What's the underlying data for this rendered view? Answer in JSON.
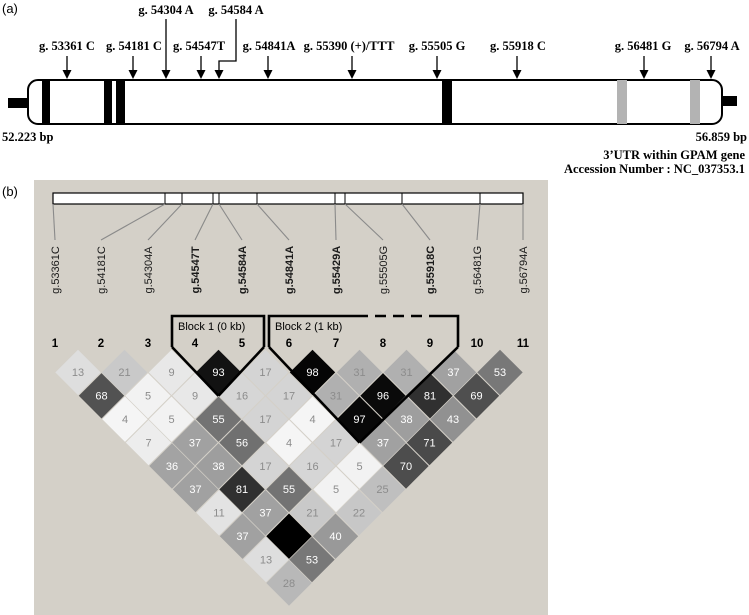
{
  "figure": {
    "panel_a": {
      "tag": "(a)",
      "start_bp": "52.223 bp",
      "end_bp": "56.859 bp",
      "caption_line1": "3’UTR within GPAM gene",
      "caption_line2": "Accession Number : NC_037353.1",
      "markers": [
        {
          "label": "g. 53361 C",
          "row": "mid",
          "label_x": 67,
          "arrow_x": 67,
          "connector": "straight"
        },
        {
          "label": "g. 54181 C",
          "row": "mid",
          "label_x": 134,
          "arrow_x": 133,
          "connector": "straight"
        },
        {
          "label": "g. 54304 A",
          "row": "top",
          "label_x": 166,
          "arrow_x": 166,
          "connector": "long"
        },
        {
          "label": "g. 54547T",
          "row": "mid",
          "label_x": 199,
          "arrow_x": 201,
          "connector": "straight"
        },
        {
          "label": "g. 54584 A",
          "row": "top",
          "label_x": 236,
          "arrow_x": 219,
          "connector": "elbow"
        },
        {
          "label": "g. 54841A",
          "row": "mid",
          "label_x": 269,
          "arrow_x": 268,
          "connector": "straight"
        },
        {
          "label": "g. 55390 (+)/TTT",
          "row": "mid",
          "label_x": 349,
          "arrow_x": 352,
          "connector": "straight"
        },
        {
          "label": "g. 55505 G",
          "row": "mid",
          "label_x": 437,
          "arrow_x": 437,
          "connector": "straight"
        },
        {
          "label": "g. 55918 C",
          "row": "mid",
          "label_x": 518,
          "arrow_x": 517,
          "connector": "straight"
        },
        {
          "label": "g. 56481 G",
          "row": "mid",
          "label_x": 643,
          "arrow_x": 644,
          "connector": "straight"
        },
        {
          "label": "g. 56794 A",
          "row": "mid",
          "label_x": 712,
          "arrow_x": 711,
          "connector": "straight"
        }
      ],
      "black_bands": [
        {
          "x": 42,
          "w": 8
        },
        {
          "x": 104,
          "w": 8
        },
        {
          "x": 116,
          "w": 9
        },
        {
          "x": 442,
          "w": 10
        }
      ],
      "gray_bands": [
        {
          "x": 617,
          "w": 10
        },
        {
          "x": 690,
          "w": 10
        }
      ]
    },
    "panel_b": {
      "tag": "(b)",
      "snps": [
        {
          "label": "g.53361C",
          "bold": false,
          "tick_x": 53,
          "label_x": 55
        },
        {
          "label": "g.54181C",
          "bold": false,
          "tick_x": 165,
          "label_x": 101
        },
        {
          "label": "g.54304A",
          "bold": false,
          "tick_x": 182,
          "label_x": 148
        },
        {
          "label": "g.54547T",
          "bold": true,
          "tick_x": 213,
          "label_x": 195
        },
        {
          "label": "g.54584A",
          "bold": true,
          "tick_x": 219,
          "label_x": 242
        },
        {
          "label": "g.54841A",
          "bold": true,
          "tick_x": 257,
          "label_x": 289
        },
        {
          "label": "g.55429A",
          "bold": true,
          "tick_x": 335,
          "label_x": 336
        },
        {
          "label": "g.55505G",
          "bold": false,
          "tick_x": 345,
          "label_x": 383
        },
        {
          "label": "g.55918C",
          "bold": true,
          "tick_x": 402,
          "label_x": 430
        },
        {
          "label": "g.56481G",
          "bold": false,
          "tick_x": 480,
          "label_x": 477
        },
        {
          "label": "g.56794A",
          "bold": false,
          "tick_x": 523,
          "label_x": 523
        }
      ],
      "column_numbers": [
        "1",
        "2",
        "3",
        "4",
        "5",
        "6",
        "7",
        "8",
        "9",
        "10",
        "11"
      ],
      "blocks": [
        {
          "label": "Block 1 (0 kb)",
          "from": 4,
          "to": 5,
          "x_left": 172,
          "x_right": 264,
          "label_x": 178
        },
        {
          "label": "Block 2 (1 kb)",
          "from": 6,
          "to": 9,
          "x_left": 269,
          "x_right": 458,
          "label_x": 275,
          "dash_from": 357,
          "dash_to": 434
        }
      ],
      "ld_rows": [
        {
          "d": 1,
          "values": [
            13,
            21,
            9,
            93,
            17,
            98,
            31,
            31,
            37,
            53
          ]
        },
        {
          "d": 2,
          "values": [
            68,
            5,
            9,
            16,
            17,
            31,
            96,
            81,
            69
          ]
        },
        {
          "d": 3,
          "values": [
            4,
            5,
            55,
            17,
            4,
            97,
            38,
            43
          ]
        },
        {
          "d": 4,
          "values": [
            7,
            37,
            56,
            4,
            17,
            37,
            71
          ]
        },
        {
          "d": 5,
          "values": [
            36,
            38,
            17,
            16,
            5,
            70
          ]
        },
        {
          "d": 6,
          "values": [
            37,
            81,
            55,
            5,
            25
          ]
        },
        {
          "d": 7,
          "values": [
            11,
            37,
            21,
            22
          ]
        },
        {
          "d": 8,
          "values": [
            37,
            100,
            40
          ]
        },
        {
          "d": 9,
          "values": [
            13,
            53
          ]
        },
        {
          "d": 10,
          "values": [
            28
          ]
        }
      ]
    }
  },
  "chart_data": {
    "type": "heatmap",
    "labels": [
      "g.53361C",
      "g.54181C",
      "g.54304A",
      "g.54547T",
      "g.54584A",
      "g.54841A",
      "g.55429A",
      "g.55505G",
      "g.55918C",
      "g.56481G",
      "g.56794A"
    ],
    "pairwise_values_by_distance": [
      [
        13,
        21,
        9,
        93,
        17,
        98,
        31,
        31,
        37,
        53
      ],
      [
        68,
        5,
        9,
        16,
        17,
        31,
        96,
        81,
        69
      ],
      [
        4,
        5,
        55,
        17,
        4,
        97,
        38,
        43
      ],
      [
        7,
        37,
        56,
        4,
        17,
        37,
        71
      ],
      [
        36,
        38,
        17,
        16,
        5,
        70
      ],
      [
        37,
        81,
        55,
        5,
        25
      ],
      [
        11,
        37,
        21,
        22
      ],
      [
        37,
        100,
        40
      ],
      [
        13,
        53
      ],
      [
        28
      ]
    ],
    "blocks": [
      {
        "label": "Block 1 (0 kb)",
        "markers": [
          4,
          5
        ]
      },
      {
        "label": "Block 2 (1 kb)",
        "markers": [
          6,
          7,
          8,
          9
        ]
      }
    ],
    "scale": "0 (white) to 100 (black); 100 shown as unlabeled black diamond"
  },
  "colors": {
    "panel_b_bg": "#d4d0c8",
    "band_gray": "#b3b3b3",
    "connector": "#8a8a8a",
    "value_text_light": "#ffffff",
    "value_text_dark": "#8c8c8c"
  }
}
